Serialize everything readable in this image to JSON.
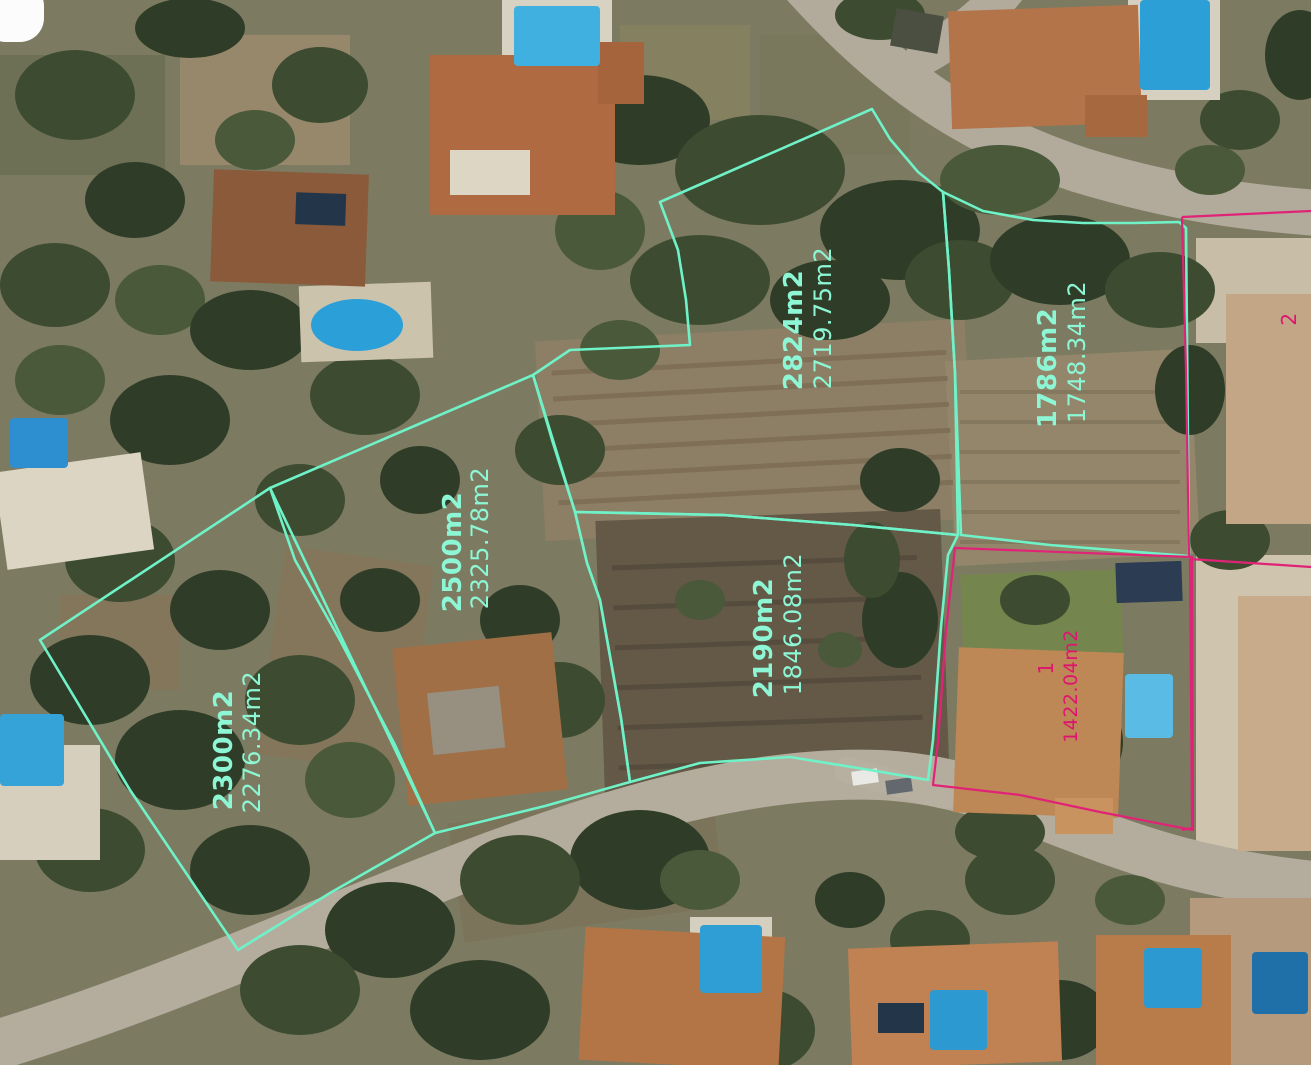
{
  "map": {
    "type": "aerial-parcel-survey",
    "colors": {
      "teal": "#70f2c8",
      "teal_text": "#8df6d4",
      "pink": "#e02376",
      "pink_text": "#de1570"
    },
    "parcels": [
      {
        "id": "parcel-2824",
        "color": "teal",
        "stroke_width": 2.6,
        "polygons": [
          "872,109 890,139 918,172 943,192 949,270 955,373 958,535 853,525 723,515 575,512 553,443 533,375 570,350 690,345 686,300 678,250 660,202"
        ],
        "labels": [
          {
            "text": "2824m2",
            "x": 802,
            "y": 330,
            "size": 26,
            "bold": true
          },
          {
            "text": "2719.75m2",
            "x": 831,
            "y": 318,
            "size": 24,
            "bold": false
          }
        ]
      },
      {
        "id": "parcel-1786",
        "color": "teal",
        "stroke_width": 2.6,
        "polygons": [
          "943,192 983,211 1033,220 1083,223 1133,223 1179,222 1186,228 1189,556 1150,553 1050,545 961,535 955,373 949,270"
        ],
        "labels": [
          {
            "text": "1786m2",
            "x": 1056,
            "y": 368,
            "size": 26,
            "bold": true
          },
          {
            "text": "1748.34m2",
            "x": 1085,
            "y": 352,
            "size": 24,
            "bold": false
          }
        ]
      },
      {
        "id": "parcel-2500",
        "color": "teal",
        "stroke_width": 2.6,
        "polygons": [
          "533,375 575,512 587,563 600,600 621,718 630,782 545,806 435,833 395,745 340,640 295,560 270,488"
        ],
        "labels": [
          {
            "text": "2500m2",
            "x": 461,
            "y": 552,
            "size": 26,
            "bold": true
          },
          {
            "text": "2325.78m2",
            "x": 488,
            "y": 538,
            "size": 24,
            "bold": false
          }
        ]
      },
      {
        "id": "parcel-2190",
        "color": "teal",
        "stroke_width": 2.6,
        "polygons": [
          "575,512 723,515 853,525 958,535 948,555 941,627 933,740 928,780 870,770 790,757 700,763 630,782 621,718 600,600 587,563"
        ],
        "labels": [
          {
            "text": "2190m2",
            "x": 772,
            "y": 638,
            "size": 26,
            "bold": true
          },
          {
            "text": "1846.08m2",
            "x": 801,
            "y": 624,
            "size": 24,
            "bold": false
          }
        ]
      },
      {
        "id": "parcel-2300",
        "color": "teal",
        "stroke_width": 2.6,
        "polygons": [
          "270,488 435,833 330,893 238,950 130,790 40,640"
        ],
        "labels": [
          {
            "text": "2300m2",
            "x": 232,
            "y": 750,
            "size": 26,
            "bold": true
          },
          {
            "text": "2276.34m2",
            "x": 260,
            "y": 742,
            "size": 24,
            "bold": false
          }
        ]
      },
      {
        "id": "parcel-plot-1",
        "color": "pink",
        "stroke_width": 2.2,
        "polygons": [
          "955,548 1192,557 1193,830 1100,812 1020,795 933,785 938,742 946,630"
        ],
        "labels": [
          {
            "text": "1",
            "x": 1053,
            "y": 668,
            "size": 20,
            "bold": false
          },
          {
            "text": "1422.04m2",
            "x": 1077,
            "y": 686,
            "size": 19,
            "bold": false
          }
        ]
      },
      {
        "id": "parcel-plot-2",
        "color": "pink",
        "stroke_width": 2.2,
        "polylines": [
          "1182,217 1311,211",
          "1182,217 1186,370 1189,556",
          "1190,559 1311,567",
          "1190,559 1192,828 1182,830"
        ],
        "labels": [
          {
            "text": "2",
            "x": 1296,
            "y": 319,
            "size": 20,
            "bold": false
          }
        ]
      }
    ]
  }
}
